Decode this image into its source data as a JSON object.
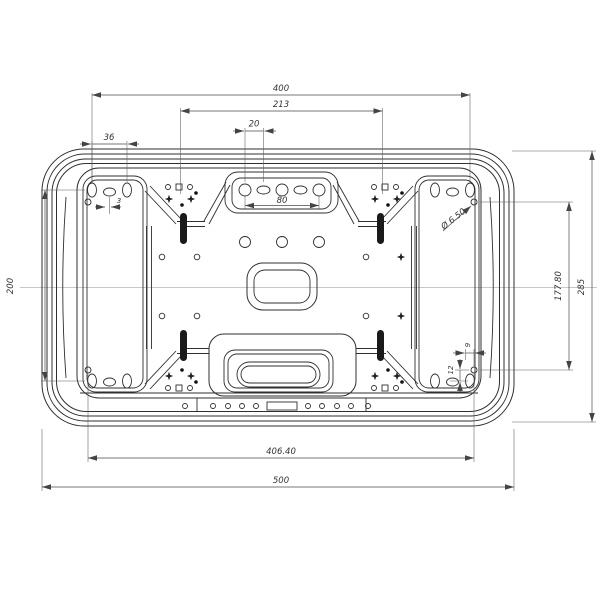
{
  "drawing": {
    "title": "Wall mount bracket plate - front view engineering drawing",
    "line_color": "#2f2f2f",
    "background": "#ffffff"
  },
  "dims": {
    "top_span": "400",
    "inner_span": "213",
    "slot_pitch": "20",
    "wing_pitch": "36",
    "offset": "3",
    "tab_span": "80",
    "hole_dia": "Ø 6.50",
    "left_height": "200",
    "right_height": "177.80",
    "overall_height": "285",
    "v_pitch": "12",
    "h_pitch": "9",
    "bottom_span": "406.40",
    "overall_width": "500"
  }
}
